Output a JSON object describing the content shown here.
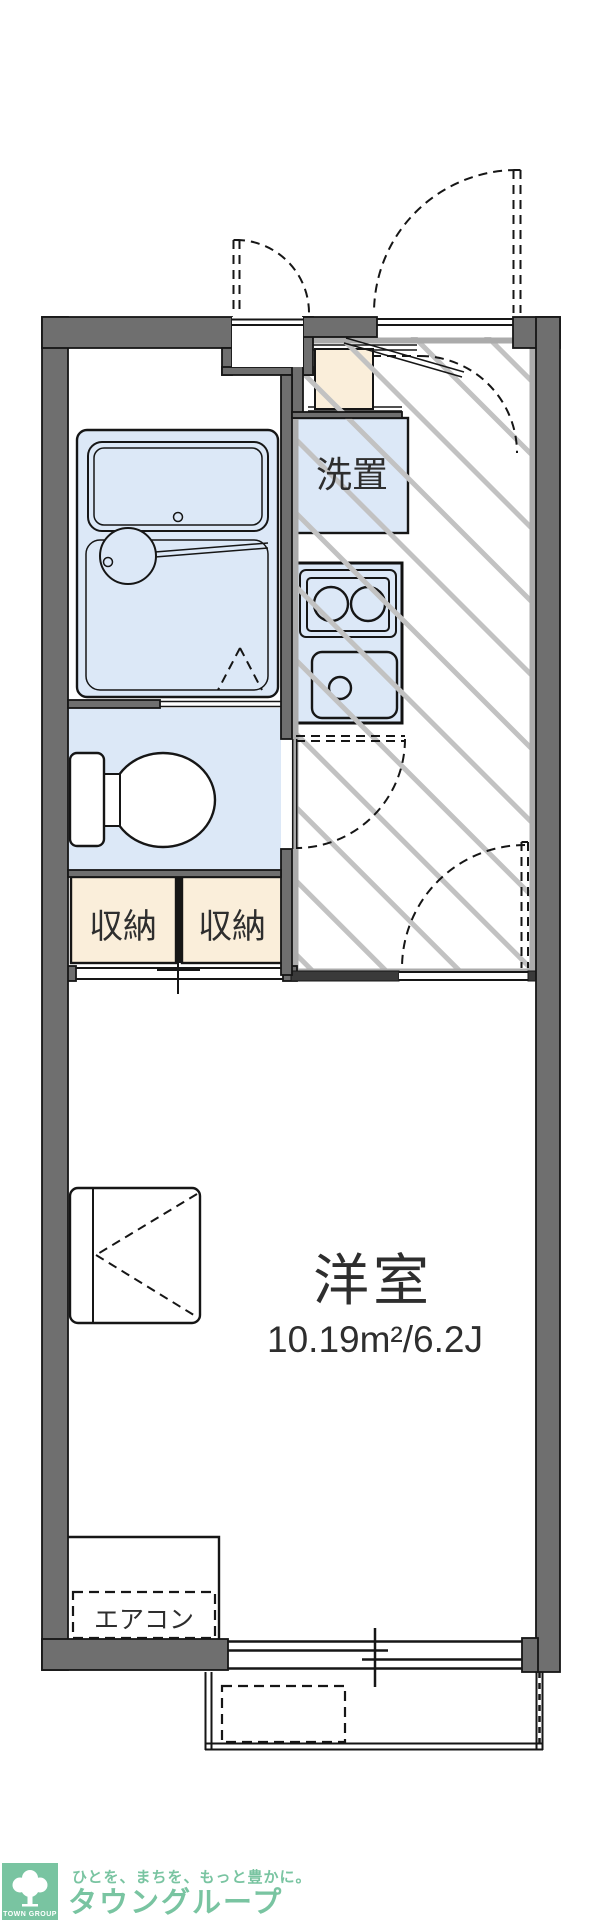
{
  "plan": {
    "washer_label": "洗置",
    "storage_left_label": "収納",
    "storage_right_label": "収納",
    "room_label": "洋室",
    "room_area": "10.19m²/6.2J",
    "aircon_label": "エアコン"
  },
  "footer": {
    "logo_square_text": "TOWN GROUP",
    "tagline": "ひとを、まちを、もっと豊かに。",
    "company": "タウングループ"
  },
  "colors": {
    "wall": "#6F6F6F",
    "fixture-blue": "#DCE8F7",
    "cream": "#FAEEDA",
    "hatch": "#C2C2C2",
    "hatch-frame": "#ABABAB",
    "line": "#161616",
    "text": "#2E2E2E",
    "brand-green": "#79C4A1"
  }
}
